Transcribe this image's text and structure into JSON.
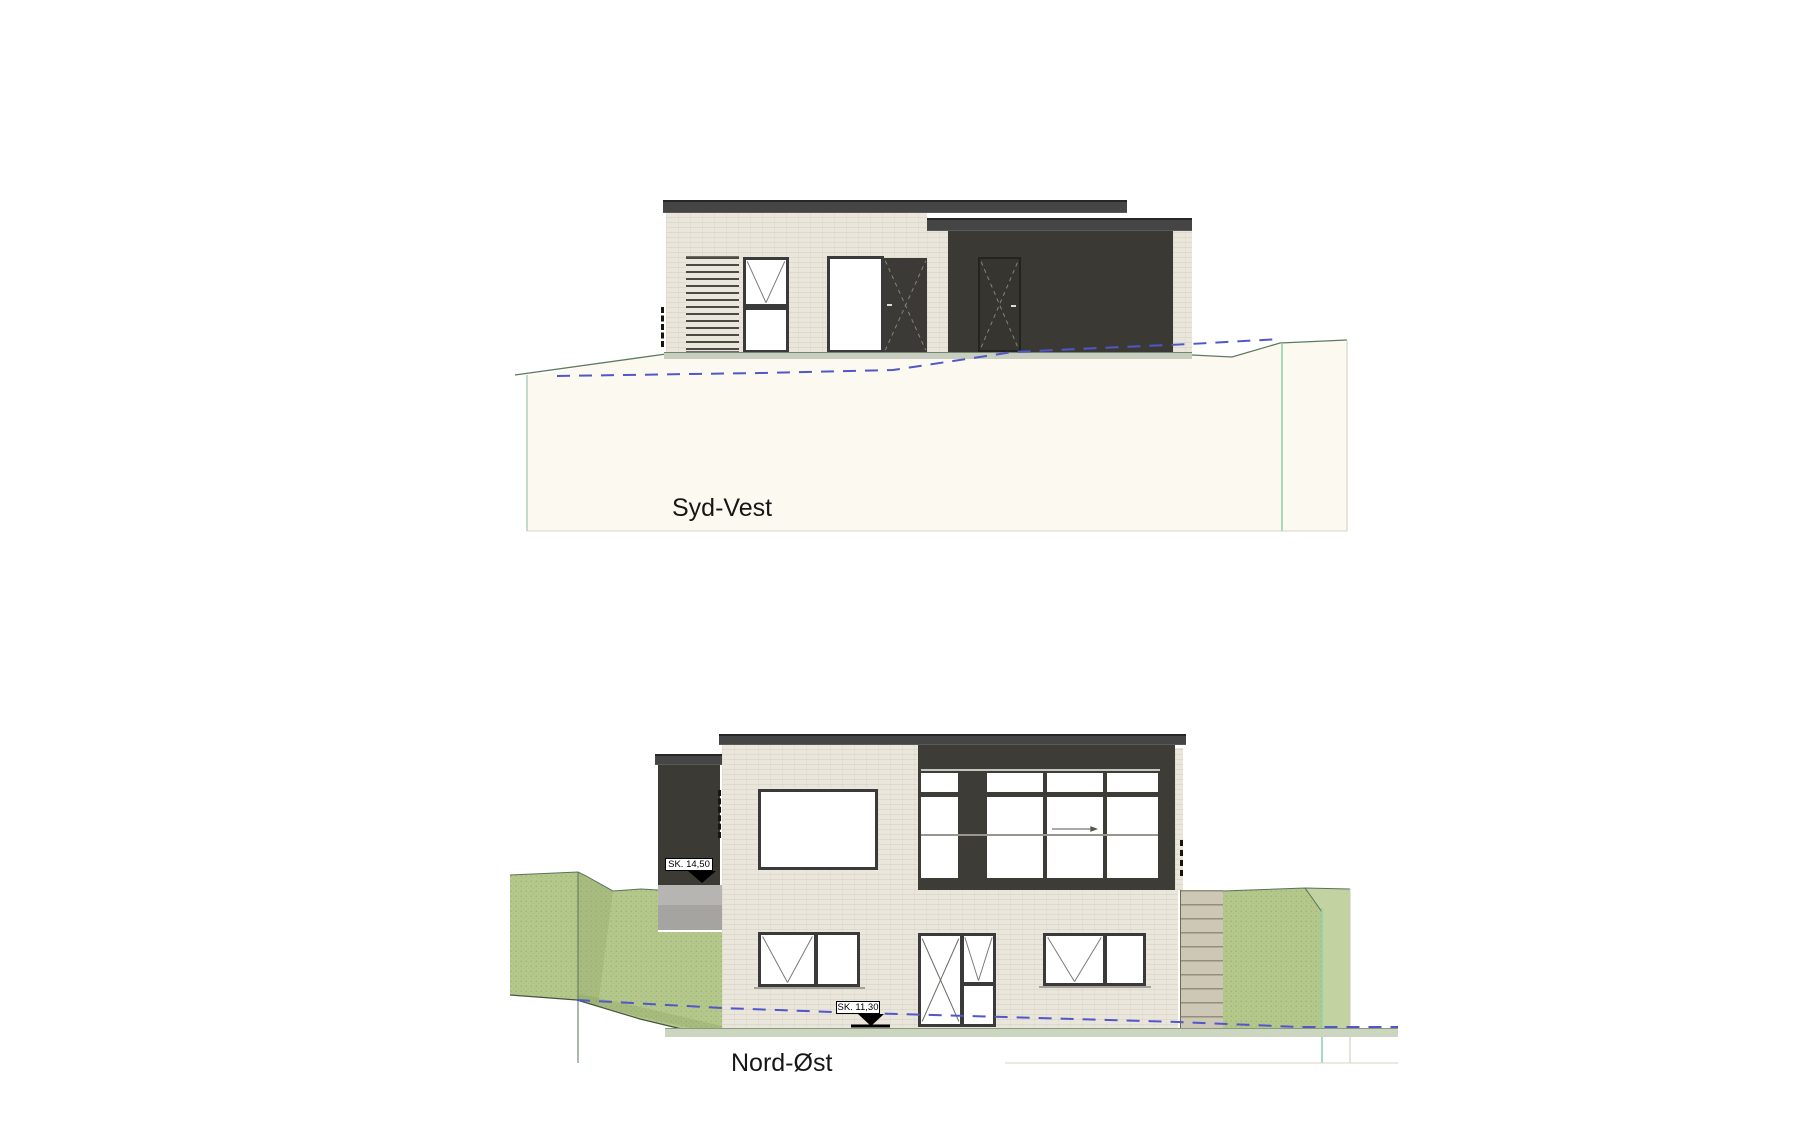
{
  "drawing": {
    "type": "architectural-elevation-sheet",
    "elevations": [
      {
        "id": "syd-vest",
        "label": "Syd-Vest"
      },
      {
        "id": "nord-oest",
        "label": "Nord-Øst"
      }
    ],
    "level_markers": [
      {
        "label": "SK. 14,50"
      },
      {
        "label": "SK. 11,30"
      }
    ]
  },
  "palette": {
    "paper": "#ffffff",
    "brick": "#eae6db",
    "darkclad": "#3d3c38",
    "darkdoor": "#36352f",
    "roof": "#454545",
    "roofedge": "#262626",
    "frame": "#3a3a3a",
    "pane": "#ffffff",
    "plinthgreen": "#c7cec0",
    "plinthgray": "#a5a4a0",
    "terrainfill": "#fcfaf0",
    "terrainline": "#5d7a5e",
    "grass": "#b5c88c",
    "grassdark": "#8aa362",
    "grassline": "#57745a",
    "stair": "#cdc7b6",
    "stairline": "#948e7c",
    "dashblue": "#5156c8",
    "brightgreen": "#8ed3ab",
    "faintline": "#d9d3c3"
  }
}
